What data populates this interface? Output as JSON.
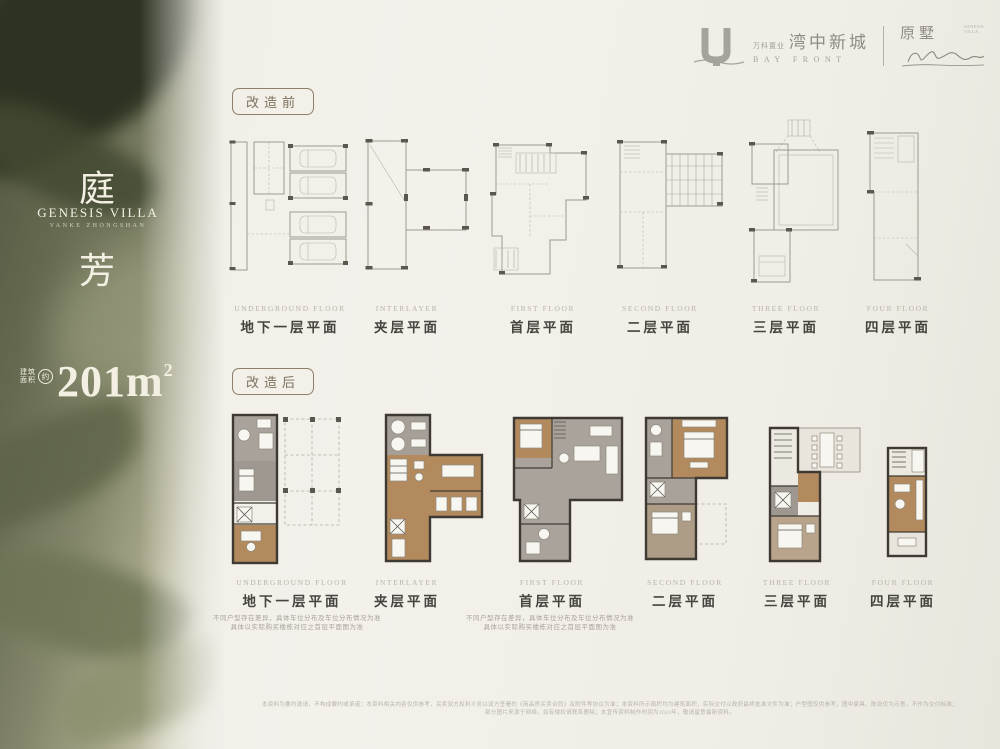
{
  "sidebar": {
    "title_top": "庭",
    "title_bottom": "芳",
    "subtitle": "GENESIS VILLA",
    "subtitle_small": "VANKE ZHONGSHAN",
    "area_label_top": "建筑",
    "area_label_bottom": "面积",
    "area_circle": "约",
    "area_number": "201",
    "area_unit": "m",
    "area_sup": "2"
  },
  "header": {
    "company": "万科置业",
    "project_cn": "湾中新城",
    "project_en": "BAY FRONT",
    "brand_cn": "原墅",
    "brand_tag": "GENESIS VILLA"
  },
  "sections": {
    "before_tag": "改造前",
    "after_tag": "改造后"
  },
  "floors": [
    {
      "en": "UNDERGROUND FLOOR",
      "cn": "地下一层平面"
    },
    {
      "en": "INTERLAYER",
      "cn": "夹层平面"
    },
    {
      "en": "FIRST FLOOR",
      "cn": "首层平面"
    },
    {
      "en": "SECOND FLOOR",
      "cn": "二层平面"
    },
    {
      "en": "THREE FLOOR",
      "cn": "三层平面"
    },
    {
      "en": "FOUR FLOOR",
      "cn": "四层平面"
    }
  ],
  "notes": {
    "left": {
      "line1": "不同户型存在差异，具体车位分布及车位分布情况为准",
      "line2": "具体以实际购买楼栋对应之首层平面图为准"
    },
    "right": {
      "line1": "不同户型存在差异，具体车位分布及车位分布情况为准",
      "line2": "具体以实际购买楼栋对应之首层平面图为准"
    }
  },
  "footer": {
    "line1": "本资料为要约邀请，不构成要约或承诺；本资料相关内容仅供参考，买卖双方权利义务以双方签署的《商品房买卖合同》及附件等协议为准；本资料所示面积均为建筑面积，实际交付以政府最终批准文件为准；户型图仅供参考，图中家具、陈设仅为示意，不作为交付标准；",
    "line2": "部分图片来源于网络，如有侵权请联系删除；本宣传资料制作时间为2023年，敬请留意最新资料。"
  }
}
